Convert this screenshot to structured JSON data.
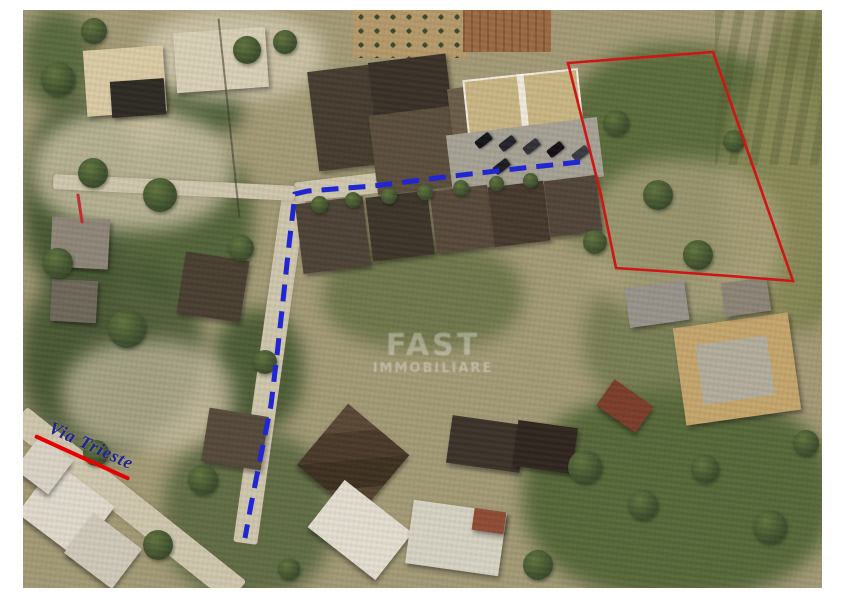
{
  "image": {
    "description": "Aerial satellite photo of a residential neighborhood with an outlined land parcel and a dashed access route",
    "border_color": "#ffffff"
  },
  "annotations": {
    "street_label": {
      "text": "Via  Trieste",
      "color": "#23238f",
      "underline_color": "#e80000"
    },
    "parcel_outline": {
      "color": "#cf1616",
      "points": "545,53 690,42 770,271 707,266 637,261 593,258 578,185"
    },
    "route_path": {
      "color": "#2026d2",
      "dash": "17 10",
      "points": "557,152 500,158 430,166 350,176 285,181 272,184 266,235 259,300 254,345 248,395 238,445 228,495 222,528"
    },
    "red_mark": {
      "color": "#c03030"
    },
    "watermark": {
      "line1": "FAST",
      "line2": "IMMOBILIARE",
      "color": "#ffffff"
    }
  }
}
